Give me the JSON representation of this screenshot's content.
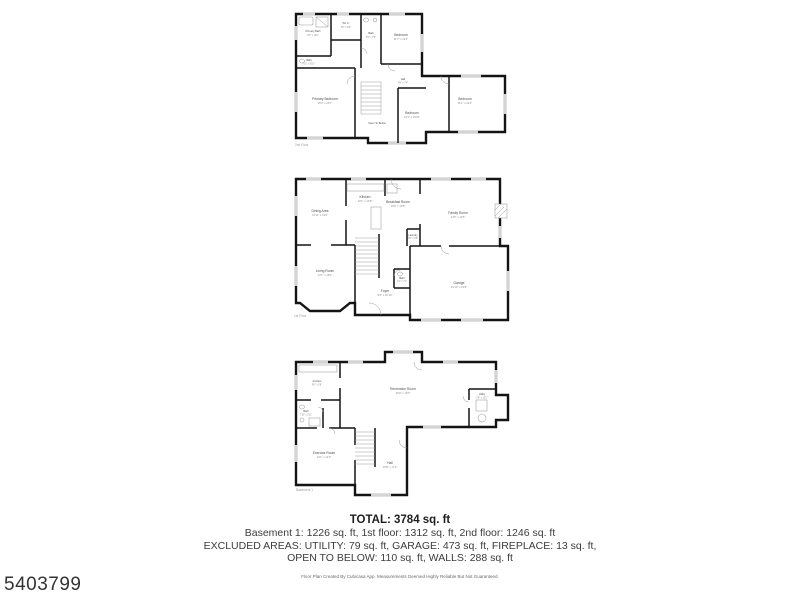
{
  "listing_id": "5403799",
  "summary": {
    "total": "TOTAL: 3784 sq. ft",
    "floors_line": "Basement 1: 1226 sq. ft, 1st floor: 1312 sq. ft, 2nd floor: 1246 sq. ft",
    "excluded_line1": "EXCLUDED AREAS: UTILITY: 79 sq. ft, GARAGE: 473 sq. ft, FIREPLACE: 13 sq. ft,",
    "excluded_line2": "OPEN TO BELOW: 110 sq. ft, WALLS: 288 sq. ft",
    "disclaimer": "Floor Plan Created By Cubicasa App. Measurements Deemed Highly Reliable But Not Guaranteed."
  },
  "floors": [
    {
      "caption": "2nd Floor",
      "rooms": [
        {
          "name": "Primary Bath",
          "dims": "8'3\" x 12'0\""
        },
        {
          "name": "Bath",
          "dims": "6'2\" x 3'10\""
        },
        {
          "name": "W.I.C.",
          "dims": "5'6\" x 5'8\""
        },
        {
          "name": "Bath",
          "dims": "5'6\" x 7'6\""
        },
        {
          "name": "Bedroom",
          "dims": "11'7\" x 13'4\""
        },
        {
          "name": "Primary Bedroom",
          "dims": "15'3\" x 20'7\""
        },
        {
          "name": "Hall",
          "dims": "9'6\" x 7'4\""
        },
        {
          "name": "Open To Below",
          "dims": ""
        },
        {
          "name": "Bedroom",
          "dims": "12'3\" x 15'10\""
        },
        {
          "name": "Bedroom",
          "dims": "11'1\" x 14'0\""
        }
      ]
    },
    {
      "caption": "1st Floor",
      "rooms": [
        {
          "name": "Dining Area",
          "dims": "11'11\" x 13'0\""
        },
        {
          "name": "Kitchen",
          "dims": "10'1\" x 14'8\""
        },
        {
          "name": "Breakfast Room",
          "dims": "10'5\" x 10'5\""
        },
        {
          "name": "Family Room",
          "dims": "14'5\" x 19'6\""
        },
        {
          "name": "Laundry",
          "dims": "6'0\" x 6'9\""
        },
        {
          "name": "Living Room",
          "dims": "13'1\" x 18'4\""
        },
        {
          "name": "Foyer",
          "dims": "9'6\" x 10'10\""
        },
        {
          "name": "Bath",
          "dims": "3'1\" x 7'1\""
        },
        {
          "name": "Garage",
          "dims": "21'10\" x 21'8\""
        }
      ]
    },
    {
      "caption": "Basement 1",
      "rooms": [
        {
          "name": "Kitchen",
          "dims": "9'0\" x 5'8\""
        },
        {
          "name": "Recreation Room",
          "dims": "40'9\" x 19'0\""
        },
        {
          "name": "Utility",
          "dims": "5'4\" x 13'2\""
        },
        {
          "name": "Bath",
          "dims": "7'10\" x 5'11\""
        },
        {
          "name": "Exercise Room",
          "dims": "13'1\" x 14'9\""
        },
        {
          "name": "Hall",
          "dims": "13'8\" x 17'2\""
        }
      ]
    }
  ]
}
